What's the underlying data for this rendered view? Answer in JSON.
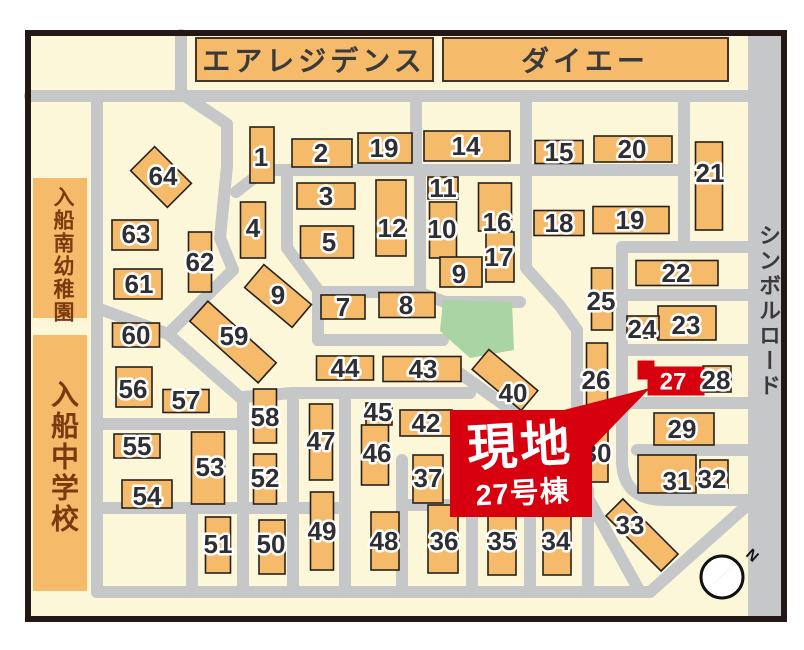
{
  "map": {
    "banners": [
      {
        "label": "エアレジデンス"
      },
      {
        "label": "ダイエー"
      }
    ],
    "landmarks": {
      "kindergarten": "入船南幼稚園",
      "school": "入船中学校",
      "road": "シンボルロード"
    },
    "callout": {
      "line1": "現地",
      "line2": "27号棟"
    },
    "site": {
      "number": "27"
    },
    "compass": {
      "label": "N"
    },
    "colors": {
      "bg": "#fdf7da",
      "road": "#c6c7c9",
      "building": "#f5bb6b",
      "outline": "#26211c",
      "label": "#2f2f33",
      "park": "#a9d4a4",
      "red": "#d7000f",
      "frame": "#231815",
      "strip_text": "#7b3a0e",
      "banner_text": "#3a3a3c"
    },
    "buildings_format": [
      "number",
      "cx",
      "cy",
      "w",
      "h",
      "rotation",
      "label_x",
      "label_y"
    ],
    "buildings": [
      [
        "1",
        262,
        155,
        24,
        56,
        0,
        261,
        157
      ],
      [
        "2",
        322,
        153,
        60,
        28,
        0,
        321,
        153
      ],
      [
        "19",
        385,
        148,
        54,
        30,
        0,
        384,
        148
      ],
      [
        "14",
        467,
        146,
        86,
        30,
        0,
        466,
        146
      ],
      [
        "15",
        559,
        152,
        48,
        23,
        0,
        559,
        152
      ],
      [
        "20",
        633,
        149,
        78,
        26,
        0,
        632,
        149
      ],
      [
        "21",
        709,
        186,
        27,
        88,
        0,
        710,
        173
      ],
      [
        "3",
        326,
        196,
        58,
        26,
        0,
        326,
        196
      ],
      [
        "12",
        391,
        218,
        30,
        76,
        0,
        392,
        228
      ],
      [
        "4",
        253,
        230,
        25,
        56,
        0,
        253,
        228
      ],
      [
        "5",
        327,
        242,
        53,
        32,
        0,
        329,
        242
      ],
      [
        "11",
        443,
        188,
        30,
        22,
        0,
        443,
        188
      ],
      [
        "10",
        443,
        230,
        27,
        56,
        0,
        442,
        229
      ],
      [
        "16",
        495,
        207,
        33,
        48,
        0,
        497,
        222
      ],
      [
        "17",
        500,
        257,
        28,
        50,
        0,
        499,
        257
      ],
      [
        "9",
        461,
        272,
        42,
        30,
        0,
        459,
        274
      ],
      [
        "18",
        559,
        223,
        50,
        25,
        0,
        559,
        223
      ],
      [
        "19",
        631,
        220,
        76,
        27,
        0,
        630,
        220
      ],
      [
        "22",
        677,
        273,
        82,
        25,
        0,
        676,
        273
      ],
      [
        "25",
        602,
        299,
        21,
        62,
        0,
        601,
        301
      ],
      [
        "26",
        597,
        374,
        21,
        62,
        0,
        596,
        380
      ],
      [
        "23",
        687,
        323,
        58,
        34,
        0,
        686,
        325
      ],
      [
        "24",
        643,
        327,
        32,
        22,
        0,
        642,
        329
      ],
      [
        "28",
        717,
        379,
        28,
        26,
        0,
        716,
        380
      ],
      [
        "29",
        684,
        429,
        60,
        32,
        0,
        682,
        429
      ],
      [
        "31",
        667,
        474,
        58,
        38,
        0,
        677,
        481
      ],
      [
        "32",
        714,
        474,
        28,
        28,
        0,
        712,
        479
      ],
      [
        "30",
        597,
        451,
        22,
        62,
        0,
        597,
        453
      ],
      [
        "33",
        642,
        535,
        78,
        24,
        45,
        630,
        525
      ],
      [
        "40",
        505,
        380,
        64,
        26,
        40,
        513,
        393
      ],
      [
        "43",
        422,
        369,
        78,
        25,
        0,
        423,
        369
      ],
      [
        "44",
        345,
        368,
        57,
        24,
        0,
        345,
        368
      ],
      [
        "42",
        426,
        423,
        52,
        26,
        0,
        426,
        423
      ],
      [
        "45",
        379,
        414,
        26,
        22,
        0,
        378,
        412
      ],
      [
        "46",
        375,
        455,
        27,
        60,
        0,
        377,
        453
      ],
      [
        "37",
        428,
        479,
        30,
        48,
        0,
        428,
        478
      ],
      [
        "36",
        443,
        539,
        30,
        68,
        0,
        444,
        541
      ],
      [
        "35",
        502,
        540,
        28,
        70,
        0,
        502,
        541
      ],
      [
        "34",
        557,
        540,
        28,
        70,
        0,
        556,
        541
      ],
      [
        "47",
        321,
        442,
        23,
        76,
        0,
        321,
        441
      ],
      [
        "49",
        322,
        531,
        23,
        78,
        0,
        322,
        531
      ],
      [
        "48",
        385,
        541,
        28,
        58,
        0,
        384,
        541
      ],
      [
        "50",
        272,
        547,
        26,
        54,
        0,
        271,
        544
      ],
      [
        "51",
        218,
        545,
        25,
        56,
        0,
        218,
        544
      ],
      [
        "52",
        265,
        479,
        23,
        50,
        0,
        265,
        478
      ],
      [
        "58",
        265,
        416,
        23,
        54,
        0,
        265,
        417
      ],
      [
        "53",
        208,
        468,
        33,
        72,
        0,
        210,
        467
      ],
      [
        "54",
        147,
        494,
        50,
        28,
        0,
        147,
        496
      ],
      [
        "55",
        137,
        446,
        46,
        24,
        0,
        137,
        446
      ],
      [
        "56",
        134,
        387,
        36,
        40,
        0,
        133,
        389
      ],
      [
        "57",
        186,
        401,
        46,
        23,
        0,
        186,
        400
      ],
      [
        "60",
        136,
        335,
        47,
        24,
        0,
        136,
        335
      ],
      [
        "59",
        233,
        342,
        92,
        27,
        42,
        234,
        336
      ],
      [
        "61",
        138,
        284,
        48,
        30,
        0,
        139,
        284
      ],
      [
        "62",
        200,
        262,
        23,
        60,
        0,
        200,
        262
      ],
      [
        "63",
        135,
        235,
        46,
        30,
        0,
        136,
        234
      ],
      [
        "64",
        161,
        177,
        52,
        34,
        45,
        163,
        176
      ],
      [
        "7",
        343,
        307,
        44,
        24,
        0,
        343,
        307
      ],
      [
        "8",
        407,
        305,
        56,
        25,
        0,
        406,
        305
      ],
      [
        "9",
        278,
        296,
        62,
        30,
        40,
        278,
        295
      ]
    ],
    "roads": [
      "M30,96 H748",
      "M181,35 V96",
      "M97,96 V592",
      "M97,592 H650",
      "M650,592 L753,500",
      "M416,96 V170",
      "M236,192 L264,170 L684,170",
      "M185,96 L227,124 L227,166 L220,238 L233,270",
      "M233,270 L168,334",
      "M97,308 L168,334",
      "M168,334 L243,400",
      "M243,400 V592",
      "M97,424 H243",
      "M97,508 H345",
      "M192,508 V592",
      "M287,170 V248 L318,290 V340",
      "M318,340 H443",
      "M318,292 H418 L445,302",
      "M420,170 V290",
      "M445,302 H520",
      "M526,96 V268 L560,306 L577,330",
      "M577,330 V478",
      "M458,372 L595,470",
      "M622,247 H748",
      "M622,295 H748",
      "M622,350 H748",
      "M622,403 H748",
      "M637,450 H748",
      "M684,96 V247",
      "M622,247 V460 Q622,500 665,500 L748,500",
      "M293,393 V592",
      "M345,393 V592",
      "M243,397 L293,393 H470",
      "M402,460 V592",
      "M472,505 V592",
      "M530,505 V592",
      "M588,490 V592",
      "M402,505 H588",
      "M577,478 L640,592"
    ]
  }
}
